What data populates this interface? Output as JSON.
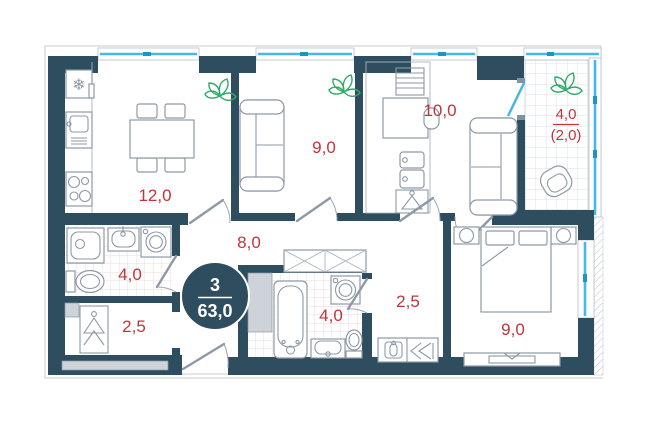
{
  "plan": {
    "type": "apartment-floorplan",
    "badge": {
      "rooms_count": "3",
      "total_area": "63,0"
    },
    "rooms": [
      {
        "id": "kitchen-living",
        "area_label": "12,0"
      },
      {
        "id": "living-room",
        "area_label": "9,0"
      },
      {
        "id": "room-top",
        "area_label": "10,0"
      },
      {
        "id": "balcony",
        "area_label": "4,0",
        "area_label_reduced": "(2,0)"
      },
      {
        "id": "hallway",
        "area_label": "8,0"
      },
      {
        "id": "bathroom-left",
        "area_label": "4,0"
      },
      {
        "id": "wardrobe",
        "area_label": "2,5"
      },
      {
        "id": "bathroom-center",
        "area_label": "4,0"
      },
      {
        "id": "hall-right",
        "area_label": "2,5"
      },
      {
        "id": "bedroom",
        "area_label": "9,0"
      }
    ],
    "icons": {
      "fridge": "❄"
    },
    "colors": {
      "wall": "#2e4d5e",
      "area_text": "#c2333b",
      "glazing": "#45b7e8",
      "plant": "#2fa968",
      "furniture_stroke": "#8d99a6"
    }
  }
}
